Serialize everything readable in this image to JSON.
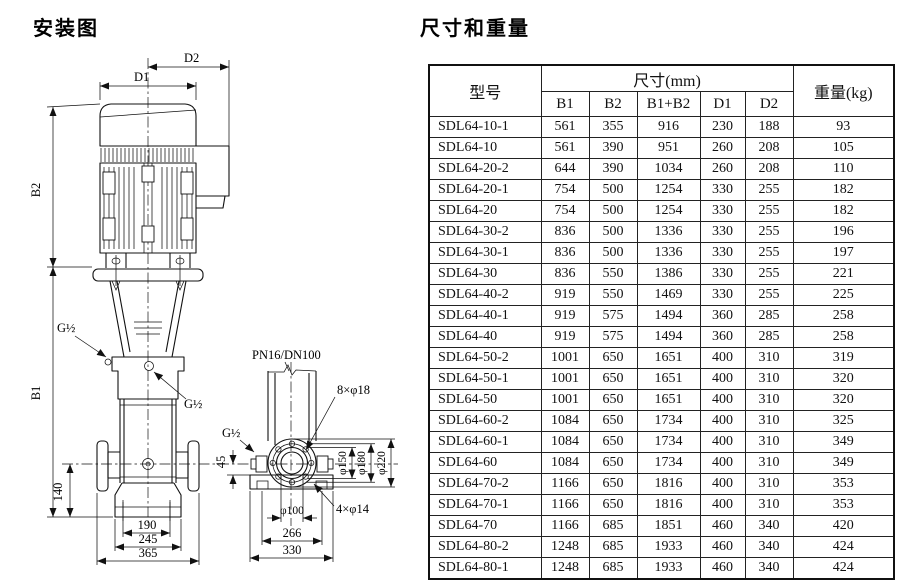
{
  "diagram": {
    "title": "安装图",
    "labels": {
      "d2": "D2",
      "d1": "D1",
      "b2": "B2",
      "b1": "B1",
      "g12_a": "G½",
      "g12_b": "G½",
      "g12_c": "G½",
      "pn": "PN16/DN100",
      "bolt8": "8×φ18",
      "bolt4": "4×φ14",
      "dim45": "45",
      "dim140": "140",
      "dim190": "190",
      "dim245": "245",
      "dim365": "365",
      "phi100": "φ100",
      "phi150": "φ150",
      "phi180": "φ180",
      "phi220": "φ220",
      "dim266": "266",
      "dim330": "330"
    }
  },
  "table": {
    "title": "尺寸和重量",
    "headers": {
      "model": "型号",
      "dims_group": "尺寸(mm)",
      "weight": "重量(kg)",
      "sub": [
        "B1",
        "B2",
        "B1+B2",
        "D1",
        "D2"
      ]
    },
    "rows": [
      [
        "SDL64-10-1",
        "561",
        "355",
        "916",
        "230",
        "188",
        "93"
      ],
      [
        "SDL64-10",
        "561",
        "390",
        "951",
        "260",
        "208",
        "105"
      ],
      [
        "SDL64-20-2",
        "644",
        "390",
        "1034",
        "260",
        "208",
        "110"
      ],
      [
        "SDL64-20-1",
        "754",
        "500",
        "1254",
        "330",
        "255",
        "182"
      ],
      [
        "SDL64-20",
        "754",
        "500",
        "1254",
        "330",
        "255",
        "182"
      ],
      [
        "SDL64-30-2",
        "836",
        "500",
        "1336",
        "330",
        "255",
        "196"
      ],
      [
        "SDL64-30-1",
        "836",
        "500",
        "1336",
        "330",
        "255",
        "197"
      ],
      [
        "SDL64-30",
        "836",
        "550",
        "1386",
        "330",
        "255",
        "221"
      ],
      [
        "SDL64-40-2",
        "919",
        "550",
        "1469",
        "330",
        "255",
        "225"
      ],
      [
        "SDL64-40-1",
        "919",
        "575",
        "1494",
        "360",
        "285",
        "258"
      ],
      [
        "SDL64-40",
        "919",
        "575",
        "1494",
        "360",
        "285",
        "258"
      ],
      [
        "SDL64-50-2",
        "1001",
        "650",
        "1651",
        "400",
        "310",
        "319"
      ],
      [
        "SDL64-50-1",
        "1001",
        "650",
        "1651",
        "400",
        "310",
        "320"
      ],
      [
        "SDL64-50",
        "1001",
        "650",
        "1651",
        "400",
        "310",
        "320"
      ],
      [
        "SDL64-60-2",
        "1084",
        "650",
        "1734",
        "400",
        "310",
        "325"
      ],
      [
        "SDL64-60-1",
        "1084",
        "650",
        "1734",
        "400",
        "310",
        "349"
      ],
      [
        "SDL64-60",
        "1084",
        "650",
        "1734",
        "400",
        "310",
        "349"
      ],
      [
        "SDL64-70-2",
        "1166",
        "650",
        "1816",
        "400",
        "310",
        "353"
      ],
      [
        "SDL64-70-1",
        "1166",
        "650",
        "1816",
        "400",
        "310",
        "353"
      ],
      [
        "SDL64-70",
        "1166",
        "685",
        "1851",
        "460",
        "340",
        "420"
      ],
      [
        "SDL64-80-2",
        "1248",
        "685",
        "1933",
        "460",
        "340",
        "424"
      ],
      [
        "SDL64-80-1",
        "1248",
        "685",
        "1933",
        "460",
        "340",
        "424"
      ]
    ]
  }
}
